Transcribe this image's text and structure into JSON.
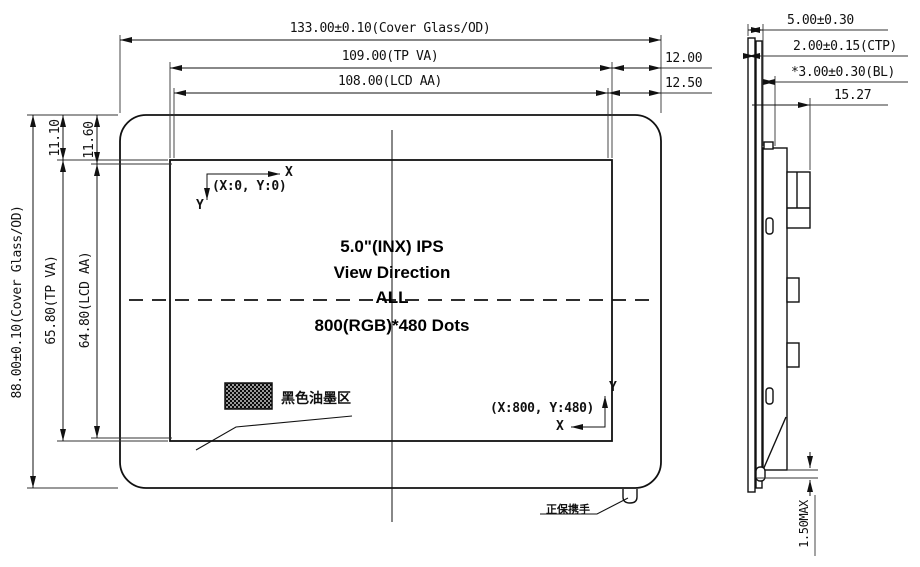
{
  "front_view": {
    "horizontal_dims": {
      "cover": "133.00±0.10(Cover Glass/OD)",
      "tp": "109.00(TP VA)",
      "lcd": "108.00(LCD AA)",
      "offset_tp": "12.00",
      "offset_lcd": "12.50"
    },
    "vertical_dims": {
      "cover": "88.00±0.10(Cover Glass/OD)",
      "tp": "65.80(TP VA)",
      "lcd": "64.80(LCD AA)",
      "offset_tp": "11.10",
      "offset_lcd": "11.60"
    },
    "origin": {
      "label": "(X:0, Y:0)",
      "x_axis": "X",
      "y_axis": "Y"
    },
    "endpoint": {
      "label": "(X:800, Y:480)",
      "x_axis": "X",
      "y_axis": "Y"
    },
    "center_text": {
      "line1": "5.0\"(INX) IPS",
      "line2": "View Direction",
      "line3": "ALL",
      "line4": "800(RGB)*480 Dots"
    },
    "ink_area_label": "黑色油墨区",
    "tab_label": "正保携手"
  },
  "side_view": {
    "dims": {
      "total": "5.00±0.30",
      "ctp": "2.00±0.15(CTP)",
      "bl": "*3.00±0.30(BL)",
      "depth": "15.27",
      "bottom_gap": "1.50MAX"
    }
  },
  "colors": {
    "line": "#1a1a1a",
    "background": "#ffffff"
  }
}
